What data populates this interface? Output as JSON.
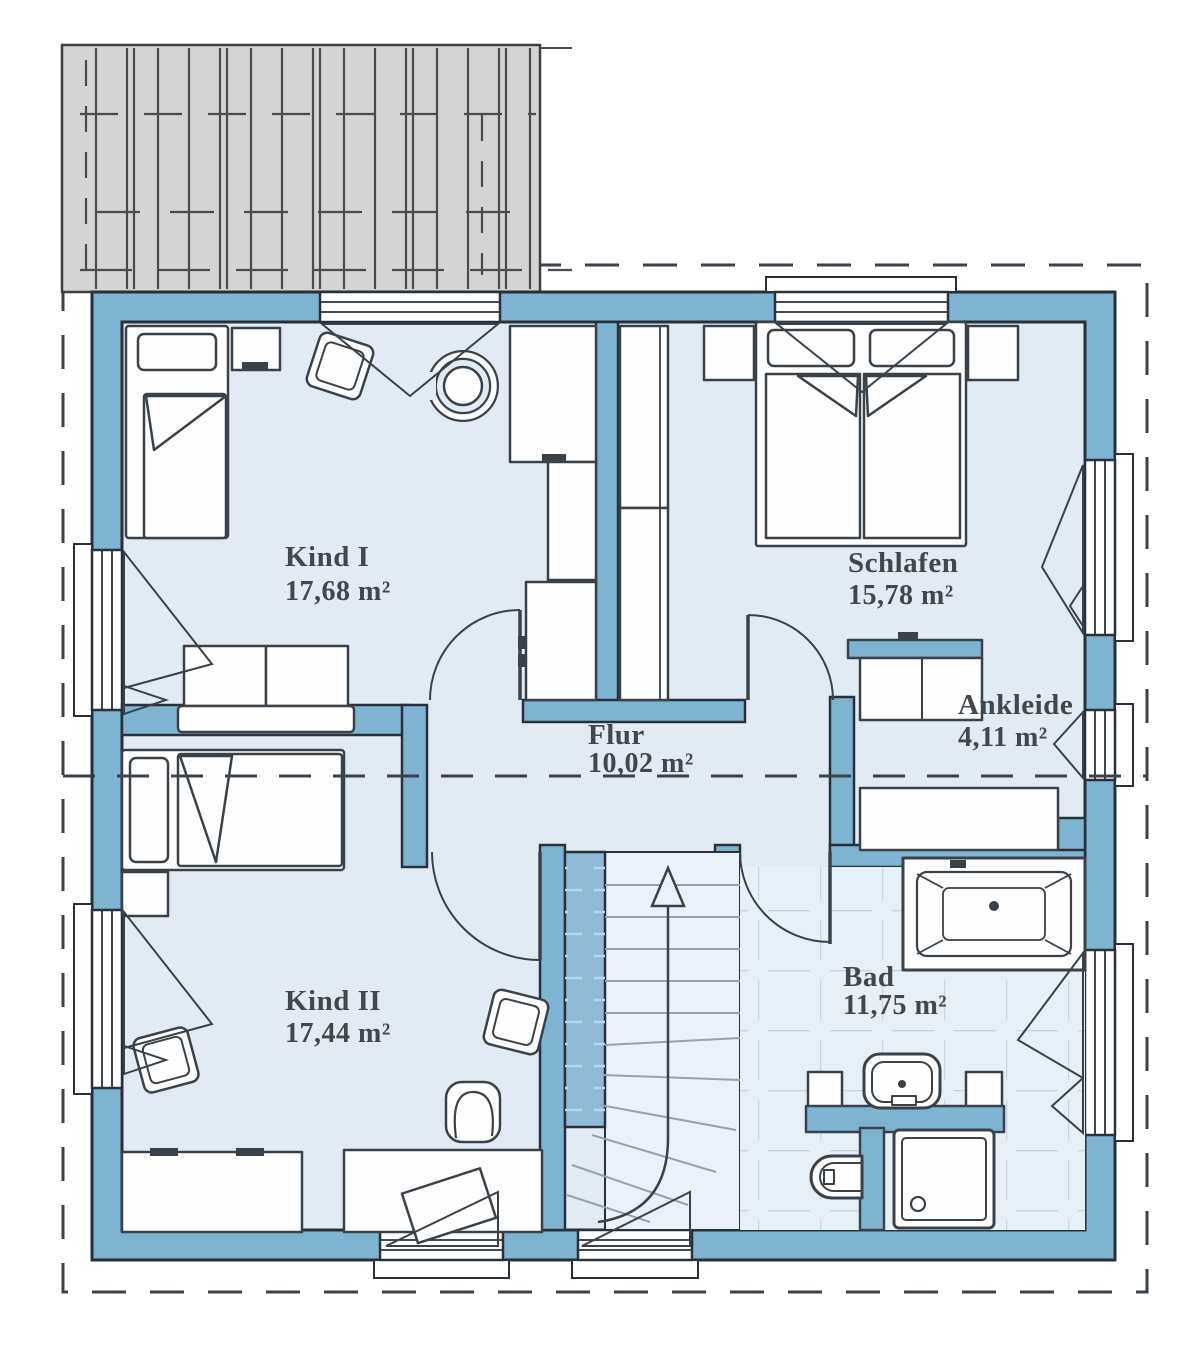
{
  "plan": {
    "rooms": {
      "kind1": {
        "name": "Kind I",
        "area": "17,68 m²"
      },
      "schlafen": {
        "name": "Schlafen",
        "area": "15,78 m²"
      },
      "ankleide": {
        "name": "Ankleide",
        "area": "4,11 m²"
      },
      "flur": {
        "name": "Flur",
        "area": "10,02 m²"
      },
      "kind2": {
        "name": "Kind II",
        "area": "17,44 m²"
      },
      "bad": {
        "name": "Bad",
        "area": "11,75 m²"
      }
    },
    "colors": {
      "wall": "#7fb3d2",
      "floor": "#e2ebf4",
      "terrace": "#d4d4d4",
      "tile_line": "#c7d2dc",
      "outline": "#28313a",
      "text": "#42474b"
    }
  }
}
